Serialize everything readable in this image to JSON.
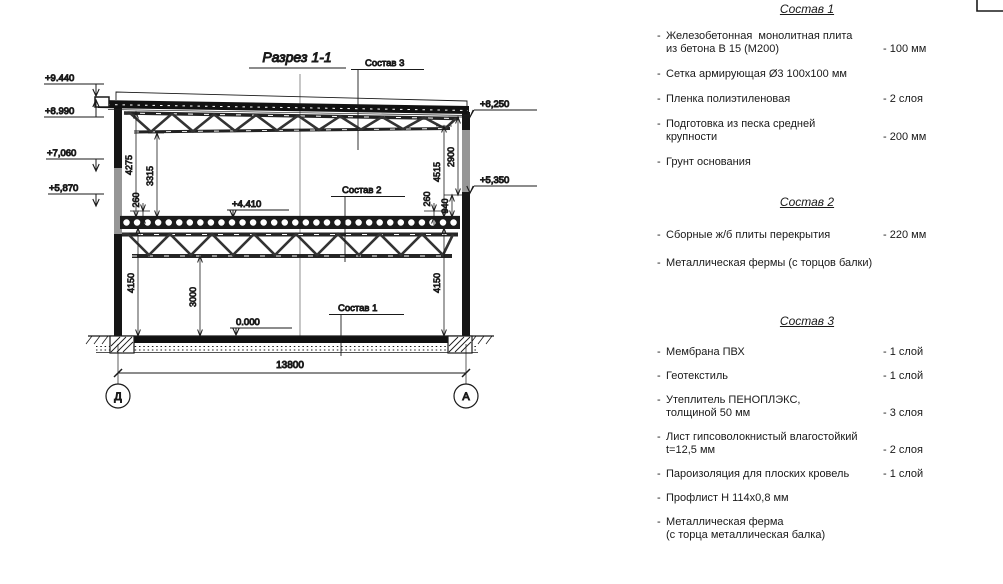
{
  "drawing": {
    "section_title": "Разрез 1-1",
    "marks_left": [
      "+9.440",
      "+8.990",
      "+7,060",
      "+5,870"
    ],
    "marks_right": [
      "+8,250",
      "+5,350"
    ],
    "mark_floor": "+4.410",
    "mark_zero": "0.000",
    "dim_roof_left_outer": "4275",
    "dim_roof_left_inner": "3315",
    "dim_slab_left": "260",
    "dim_lower_left": "4150",
    "dim_lower_mid": "3000",
    "dim_slab_right": "260",
    "dim_floor_right": "940",
    "dim_roof_right_outer": "2900",
    "dim_roof_right_inner": "4515",
    "dim_lower_right": "4150",
    "dim_total_width": "13800",
    "axis_left": "Д",
    "axis_right": "А",
    "leader_sostav3": "Состав 3",
    "leader_sostav2": "Состав 2",
    "leader_sostav1": "Состав 1"
  },
  "panel": {
    "prefix": "-",
    "sections": [
      {
        "title": "Состав 1",
        "items": [
          {
            "name": "Железобетонная  монолитная плита\nиз бетона В 15 (М200)",
            "value": "- 100 мм"
          },
          {
            "name": "Сетка армирующая Ø3 100х100 мм",
            "value": ""
          },
          {
            "name": "Пленка полиэтиленовая",
            "value": "- 2 слоя"
          },
          {
            "name": "Подготовка из песка средней\nкрупности",
            "value": "- 200 мм"
          },
          {
            "name": "Грунт основания",
            "value": ""
          }
        ]
      },
      {
        "title": "Состав 2",
        "items": [
          {
            "name": "Сборные ж/б плиты перекрытия",
            "value": "- 220 мм"
          },
          {
            "name": "Металлическая фермы (с торцов балки)",
            "value": ""
          }
        ]
      },
      {
        "title": "Состав 3",
        "items": [
          {
            "name": "Мембрана ПВХ",
            "value": "- 1 слой"
          },
          {
            "name": "Геотекстиль",
            "value": "- 1 слой"
          },
          {
            "name": "Утеплитель ПЕНОПЛЭКС,\nтолщиной 50 мм",
            "value": "- 3 слоя"
          },
          {
            "name": "Лист гипсоволокнистый влагостойкий\nt=12,5 мм",
            "value": "- 2 слоя"
          },
          {
            "name": "Пароизоляция для плоских кровель",
            "value": "- 1 слой"
          },
          {
            "name": "Профлист Н 114х0,8 мм",
            "value": ""
          },
          {
            "name": "Металлическая ферма\n(с торца металлическая балка)",
            "value": ""
          }
        ]
      }
    ]
  },
  "colors": {
    "ink": "#1a1a1a",
    "paper": "#ffffff"
  }
}
